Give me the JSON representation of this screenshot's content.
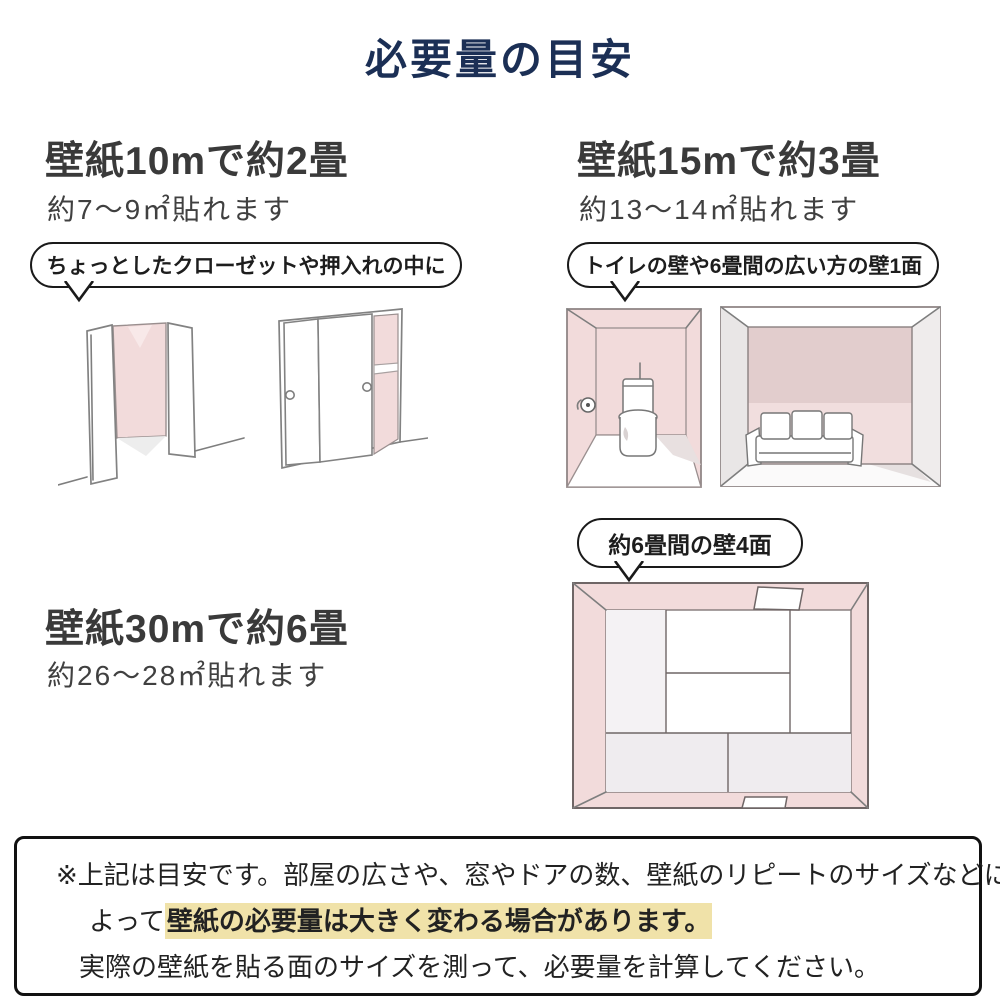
{
  "title": "必要量の目安",
  "sections": {
    "s10": {
      "heading": "壁紙10mで約2畳",
      "sub": "約7〜9㎡貼れます"
    },
    "s15": {
      "heading": "壁紙15mで約3畳",
      "sub": "約13〜14㎡貼れます"
    },
    "s30": {
      "heading": "壁紙30mで約6畳",
      "sub": "約26〜28㎡貼れます"
    }
  },
  "bubbles": {
    "closet": "ちょっとしたクローゼットや押入れの中に",
    "toilet": "トイレの壁や6畳間の広い方の壁1面",
    "room4": "約6畳間の壁4面"
  },
  "illustrations": {
    "closet_open": "open-closet-with-pink-accent-wall",
    "closet_sliding": "sliding-door-oshiire-with-pink-interior",
    "toilet_room": "toilet-room-with-pink-walls",
    "sofa_room": "six-mat-room-wide-pink-wall-with-sofa",
    "tatami_room": "six-mat-room-top-view-four-pink-walls"
  },
  "notice": {
    "line1": "※上記は目安です。部屋の広さや、窓やドアの数、壁紙のリピートのサイズなどに",
    "line2_prefix": "よって",
    "line2_highlight": "壁紙の必要量は大きく変わる場合があります。",
    "line3": "実際の壁紙を貼る面のサイズを測って、必要量を計算してください。"
  },
  "colors": {
    "title_navy": "#1b2f55",
    "wall_pink": "#f2dbdb",
    "wall_pink_dark": "#e2cdcd",
    "highlight_yellow": "#f0e2a9",
    "text_dark": "#333333"
  }
}
